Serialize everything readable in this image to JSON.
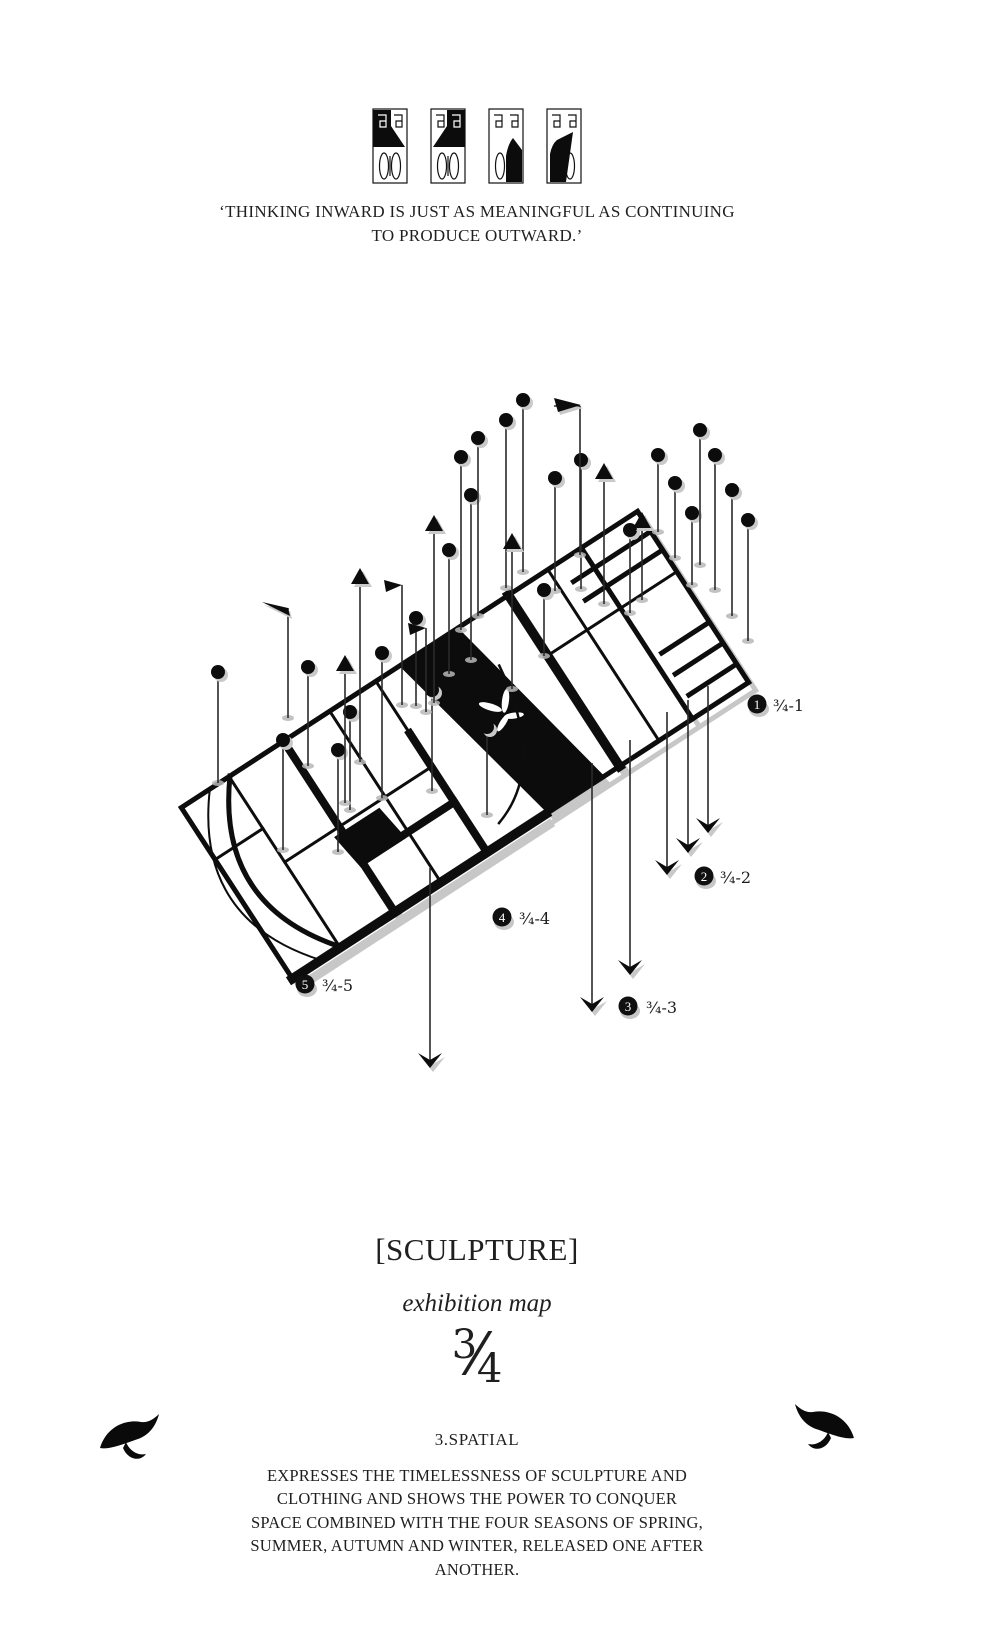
{
  "page": {
    "background": "#ffffff",
    "ink": "#0c0c0c",
    "shadow_gray": "#c7c7c7"
  },
  "header": {
    "logo_marks": [
      "figure-mark-1",
      "figure-mark-2",
      "figure-mark-3",
      "figure-mark-4"
    ],
    "quote": "‘THINKING INWARD IS JUST AS MEANINGFUL AS CONTINUING TO PRODUCE OUTWARD.’"
  },
  "map": {
    "description": "axonometric exhibition floor plan with survey poles, flags and arrows",
    "markers": [
      {
        "num": "1",
        "label": "¾-1"
      },
      {
        "num": "2",
        "label": "¾-2"
      },
      {
        "num": "3",
        "label": "¾-3"
      },
      {
        "num": "4",
        "label": "¾-4"
      },
      {
        "num": "5",
        "label": "¾-5"
      }
    ]
  },
  "footer": {
    "title": "[SCULPTURE]",
    "subtitle": "exhibition map",
    "fraction": {
      "numerator": "3",
      "slash": "⁄",
      "denominator": "4"
    },
    "section": "3.SPATIAL",
    "description": "EXPRESSES THE TIMELESSNESS OF SCULPTURE AND CLOTHING AND SHOWS THE POWER TO CONQUER SPACE COMBINED WITH THE FOUR SEASONS OF SPRING, SUMMER, AUTUMN AND WINTER, RELEASED ONE AFTER ANOTHER."
  },
  "icons": {
    "bird_left": "bird-swoosh-left",
    "bird_right": "bird-swoosh-right",
    "pole_dot": "survey-pole-dot",
    "pole_arrow_up": "survey-pole-arrow-up",
    "pole_flag": "survey-pole-flag",
    "arrow_down": "drop-arrow-down"
  }
}
